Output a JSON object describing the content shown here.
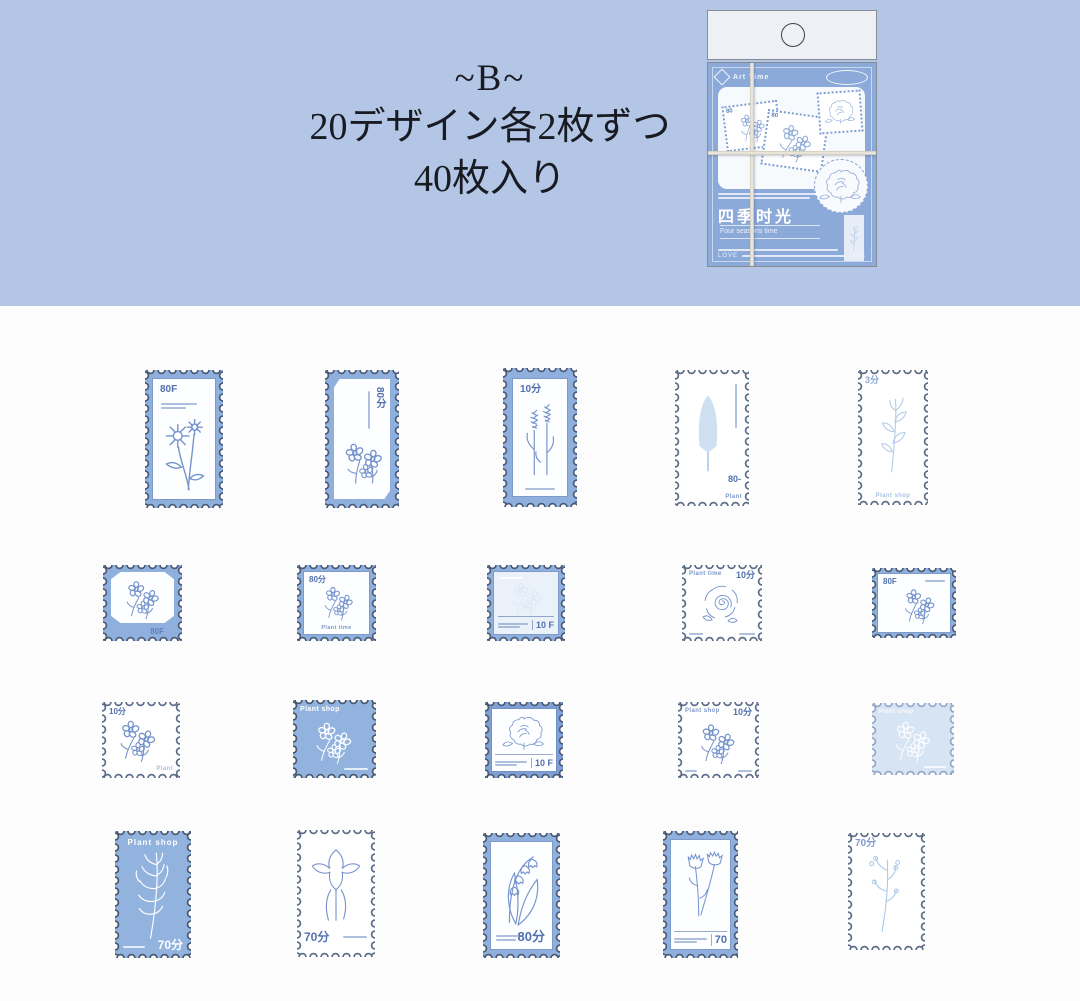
{
  "banner": {
    "line1": "~B~",
    "line2": "20デザイン各2枚ずつ",
    "line3": "40枚入り",
    "background": "#b4c6e6"
  },
  "package": {
    "brand": "Art Time",
    "title": "四季时光",
    "subtitle": "Four seasons time",
    "footer_left": "LOVE",
    "footer_right": "LIFE",
    "mini_labels": [
      "80",
      "80"
    ],
    "body_color": "#8ba9d9"
  },
  "colors": {
    "page_bg": "#fdfdfe",
    "stamp_frame_blue": "#8fb0dd",
    "stamp_solid_blue": "#93b3df",
    "stamp_pale_blue": "#d7e4f4",
    "line_art_blue": "#7492cc",
    "perforation_ring": "#4b5b77"
  },
  "stamps": [
    {
      "id": "r1c1",
      "denom": "80F",
      "label": "",
      "flower": "daisy"
    },
    {
      "id": "r1c2",
      "denom": "80分",
      "label": "",
      "flower": "sweet-pea"
    },
    {
      "id": "r1c3",
      "denom": "10分",
      "label": "",
      "flower": "lavender"
    },
    {
      "id": "r1c4",
      "denom": "80-",
      "label": "Plant",
      "flower": "lilac"
    },
    {
      "id": "r1c5",
      "denom": "3分",
      "label": "Plant shop",
      "flower": "branch"
    },
    {
      "id": "r2c1",
      "denom": "80F",
      "label": "",
      "flower": "anemone"
    },
    {
      "id": "r2c2",
      "denom": "80分",
      "label": "Plant time",
      "flower": "bouquet"
    },
    {
      "id": "r2c3",
      "denom": "10 F",
      "label": "",
      "flower": "pale-flowers"
    },
    {
      "id": "r2c4",
      "denom": "10分",
      "label": "Plant time",
      "flower": "rose"
    },
    {
      "id": "r2c5",
      "denom": "80F",
      "label": "",
      "flower": "daisy-cluster"
    },
    {
      "id": "r3c1",
      "denom": "10分",
      "label": "Plant",
      "flower": "peony-bouquet"
    },
    {
      "id": "r3c2",
      "denom": "",
      "label": "Plant shop",
      "flower": "white-flowers"
    },
    {
      "id": "r3c3",
      "denom": "10 F",
      "label": "",
      "flower": "peony"
    },
    {
      "id": "r3c4",
      "denom": "10分",
      "label": "Plant shop",
      "flower": "poppy"
    },
    {
      "id": "r3c5",
      "denom": "",
      "label": "Plant shop",
      "flower": "white-flowers"
    },
    {
      "id": "r4c1",
      "denom": "70分",
      "label": "Plant shop",
      "flower": "fern"
    },
    {
      "id": "r4c2",
      "denom": "70分",
      "label": "",
      "flower": "iris"
    },
    {
      "id": "r4c3",
      "denom": "80分",
      "label": "",
      "flower": "lily-of-the-valley"
    },
    {
      "id": "r4c4",
      "denom": "70",
      "label": "",
      "flower": "carnation"
    },
    {
      "id": "r4c5",
      "denom": "70分",
      "label": "",
      "flower": "flower-spray"
    }
  ]
}
